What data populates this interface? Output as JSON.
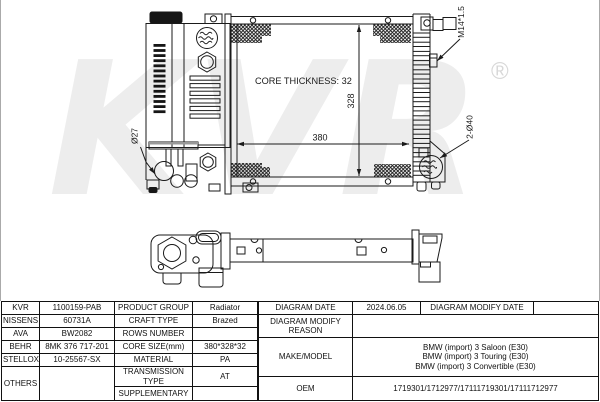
{
  "watermark": {
    "text": "KVR",
    "registered": "®",
    "color": "#ededed"
  },
  "front_view": {
    "labels": {
      "core_thickness": "CORE THICKNESS: 32",
      "height_dim": "328",
      "width_dim": "380",
      "inlet_thread": "M14*1.5",
      "outlet_diameter": "Ø27",
      "pipe_diameter": "2-Ø40"
    }
  },
  "table": {
    "brands": [
      {
        "name": "KVR",
        "value": "1100159-PAB"
      },
      {
        "name": "NISSENS",
        "value": "60731A"
      },
      {
        "name": "AVA",
        "value": "BW2082"
      },
      {
        "name": "BEHR",
        "value": "8MK 376 717-201"
      },
      {
        "name": "STELLOX",
        "value": "10-25567-SX"
      },
      {
        "name": "OTHERS",
        "value": ""
      }
    ],
    "specs": [
      {
        "label": "PRODUCT GROUP",
        "value": "Radiator"
      },
      {
        "label": "CRAFT TYPE",
        "value": "Brazed"
      },
      {
        "label": "ROWS NUMBER",
        "value": ""
      },
      {
        "label": "CORE SIZE(mm)",
        "value": "380*328*32"
      },
      {
        "label": "MATERIAL",
        "value": "PA"
      },
      {
        "label": "TRANSMISSION TYPE",
        "value": "AT"
      },
      {
        "label": "SUPPLEMENTARY",
        "value": ""
      }
    ],
    "info": {
      "diagram_date_label": "DIAGRAM DATE",
      "diagram_date": "2024.06.05",
      "modify_date_label": "DIAGRAM MODIFY DATE",
      "modify_date": "",
      "modify_reason_label": "DIAGRAM MODIFY REASON",
      "modify_reason": "",
      "make_model_label": "MAKE/MODEL",
      "make_model": [
        "BMW (import) 3 Saloon (E30)",
        "BMW (import) 3 Touring (E30)",
        "BMW (import) 3 Convertible (E30)"
      ],
      "oem_label": "OEM",
      "oem": "1719301/1712977/17111719301/17111712977"
    }
  }
}
